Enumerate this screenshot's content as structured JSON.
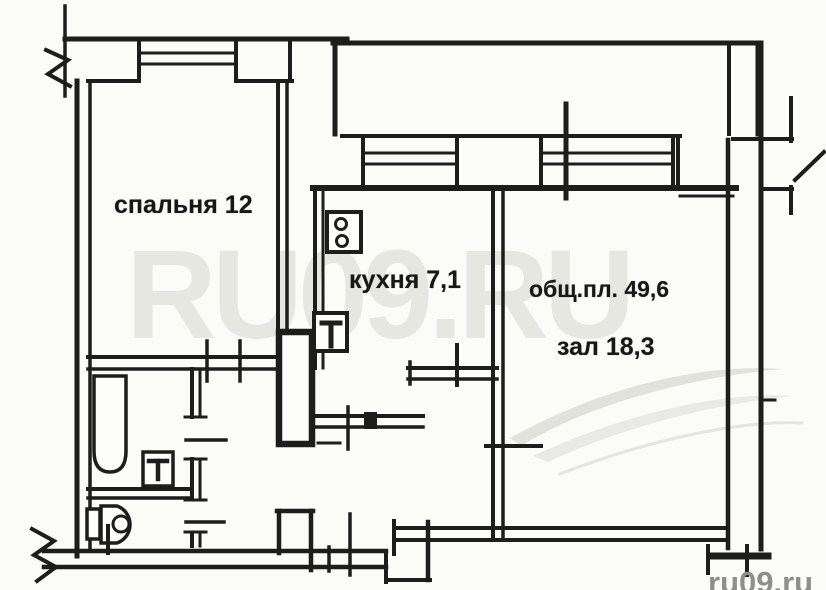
{
  "document": {
    "type": "apartment-floor-plan",
    "style": "scanned BTI technical plan"
  },
  "colors": {
    "background": "#fbfbf8",
    "ink": "#1d1d1b",
    "watermark_center": "#e7e7e2",
    "watermark_swoosh": "#cdcdc7",
    "watermark_corner": "#8e8e8a"
  },
  "rooms": [
    {
      "id": "bedroom",
      "label": "спальня 12"
    },
    {
      "id": "kitchen",
      "label": "кухня 7,1"
    },
    {
      "id": "hall",
      "label": "зал 18,3"
    }
  ],
  "summary": {
    "total_area_label": "общ.пл. 49,6"
  },
  "watermarks": {
    "center": "RU09.RU",
    "corner": "ru09.ru"
  },
  "fixtures": [
    {
      "name": "stove-icon",
      "room": "kitchen"
    },
    {
      "name": "kitchen-sink-icon",
      "room": "kitchen"
    },
    {
      "name": "bathtub-icon",
      "room": "bathroom"
    },
    {
      "name": "washbasin-icon",
      "room": "bathroom"
    },
    {
      "name": "toilet-icon",
      "room": "wc"
    }
  ]
}
